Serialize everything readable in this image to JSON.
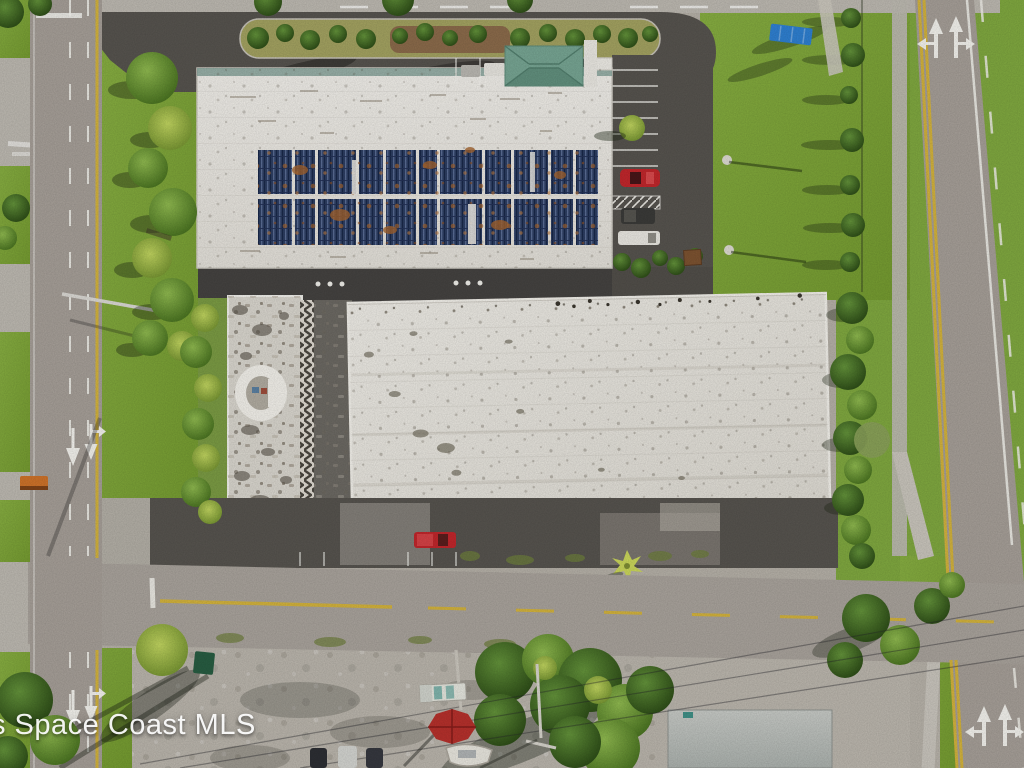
{
  "image": {
    "kind": "aerial real-estate photograph",
    "description": "Overhead drone view of a commercial property: two large white-roofed buildings (north building with a two-row rooftop solar array and a green hip-roof entrance canopy, south building with a weathered white membrane roof), a weathered west wing with a round turret, parking lots with a few vehicles, lawns, palm trees, a landscaped hedge island, public roads on the west, south and east with painted lane arrows, and a gravel lot with a boat, red umbrella and utility truck at the bottom.",
    "width_px": 1024,
    "height_px": 768
  },
  "watermark": {
    "text": "s Space Coast MLS"
  },
  "palette": {
    "grass": "#7fa73f",
    "grass-dark": "#5e8630",
    "grass-dry": "#a2a160",
    "road": "#a59e97",
    "dark-asphalt": "#56534e",
    "concrete": "#bcb8b0",
    "gravel": "#b6b1a8",
    "roof-white": "#ebe9e3",
    "roof-lower": "#e4e2db",
    "wing-roof": "#d8d5cd",
    "solar-blue": "#2d3e62",
    "solar-light": "#5e7199",
    "rust": "#a4632d",
    "entrance-roof": "#76a492",
    "teal-strip": "#7f9e95",
    "tree-green": "#6a9638",
    "tree-dark": "#3c6120",
    "yellow-line": "#d2b23c",
    "white-line": "#efeee8",
    "red-vehicle": "#c0262b",
    "blue-container": "#2e7fd0"
  },
  "scene": {
    "buildings": [
      {
        "name": "north-building",
        "roof": "white membrane",
        "features": [
          "two-row blue solar panel array with rust staining",
          "teal parapet strip",
          "green hip-roof entrance canopy",
          "dark covered walkway on south face"
        ]
      },
      {
        "name": "south-building",
        "roof": "white membrane with dark speckled weathering"
      },
      {
        "name": "west-wing",
        "roof": "heavily weathered gray with round white turret and stair zigzag"
      },
      {
        "name": "southeast-building",
        "roof": "gray, partially visible at bottom edge"
      }
    ],
    "vehicles": [
      {
        "name": "red-car",
        "location": "east parking lot"
      },
      {
        "name": "dark-van",
        "location": "east parking lot"
      },
      {
        "name": "white-camper",
        "location": "east parking lot"
      },
      {
        "name": "red-pickup",
        "location": "south parking row"
      },
      {
        "name": "white-utility-truck",
        "location": "gravel lot"
      },
      {
        "name": "boat-on-trailer",
        "location": "gravel lot"
      },
      {
        "name": "parked-car-row",
        "location": "bottom edge of frame"
      }
    ],
    "roads": [
      {
        "name": "west-road",
        "orientation": "vertical",
        "markings": [
          "white dashed lane lines",
          "yellow edge line",
          "straight arrow",
          "straight-or-right arrow"
        ]
      },
      {
        "name": "east-road",
        "orientation": "vertical",
        "markings": [
          "double yellow line",
          "left-or-straight arrow",
          "straight-or-right arrow",
          "white edge line"
        ]
      },
      {
        "name": "south-road",
        "orientation": "horizontal",
        "markings": [
          "yellow center line",
          "white stop stub"
        ]
      }
    ],
    "landscape": [
      "row of trees along west verge",
      "hedge island in north drive",
      "large east lawn with two light-pole bases",
      "blue storage container on lawn",
      "tree and fence line on east property edge",
      "dense tree canopy at bottom center",
      "red patio umbrella",
      "green dumpster",
      "power lines crossing the gravel lot"
    ]
  }
}
